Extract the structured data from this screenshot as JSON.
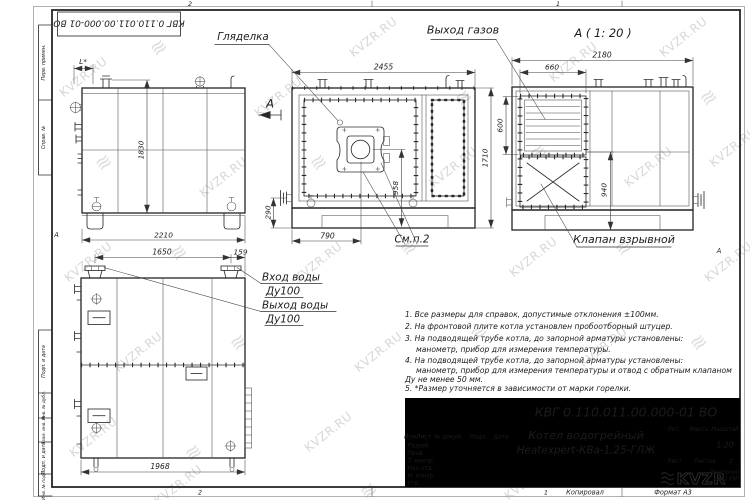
{
  "watermark": {
    "text": "KVZR.RU",
    "logo_glyph": "≋"
  },
  "sheet": {
    "doc_number_rotated": "КВГ 0.110.011.00.000-01 ВО",
    "zone_top_left": "2",
    "zone_top_right": "1",
    "zone_bottom_left": "2",
    "zone_bottom_right": "1",
    "fold_mark_left": "А",
    "fold_mark_right": "А",
    "margin_boxes": {
      "perv": "Перв. примен.",
      "sprav": "Справ. №",
      "podp1": "Подп. и дата",
      "inv_dubl": "Инв. № дубл.",
      "vzam": "Взам. инв. №",
      "podp2": "Подп. и дата",
      "inv_podl": "Инв. № подл."
    },
    "copied": "Копировал",
    "format": "Формат А3"
  },
  "views": {
    "side": {
      "dim_l": "L*",
      "dim_height": "1830",
      "dim_width": "2210",
      "view_arrow": "А"
    },
    "front": {
      "sight_glass": "Гляделка",
      "see_item": "См.п.2",
      "dim_width": "2455",
      "dim_height": "1710",
      "dim_axis": "958",
      "dim_burner": "790",
      "dim_pipe": "290"
    },
    "rear": {
      "title": "А ( 1: 20 )",
      "gas_outlet": "Выход газов",
      "explosion_valve": "Клапан взрывной",
      "dim_width": "2180",
      "dim_louver_w": "660",
      "dim_louver_h": "600",
      "dim_940": "940"
    },
    "plan": {
      "water_in": "Вход воды",
      "water_in_dn": "Ду100",
      "water_out": "Выход воды",
      "water_out_dn": "Ду100",
      "dim_1650": "1650",
      "dim_159": "159",
      "dim_1968": "1968"
    }
  },
  "notes": [
    "1. Все размеры для справок, допустимые отклонения ±100мм.",
    "2. На фронтовой плите котла установлен пробоотборный штуцер.",
    "3. На подводящей трубе котла, до запорной арматуры установлены:",
    "манометр, прибор для измерения температуры.",
    "4. На подводящей трубе котла, до запорной арматуры установлены:",
    "манометр, прибор для измерения температуры и отвод с обратным клапаном",
    "Ду не менее 50 мм.",
    "5. *Размер уточняется в зависимости от марки горелки."
  ],
  "title_block": {
    "doc_number": "КВГ 0.110.011.00.000-01 ВО",
    "product_line1": "Котел водогрейный",
    "product_line2": "Heatexpert-КВа-1,25-ГЛЖ",
    "col_izm": "Изм.",
    "col_list": "Лист",
    "col_doc": "№ докум.",
    "col_podp": "Подп.",
    "col_data": "Дата",
    "row_razrab": "Разраб.",
    "row_prov": "Пров.",
    "row_tkontr": "Т. контр.",
    "row_nach": "Нач.отд.",
    "row_nkontr": "Н. контр.",
    "row_utv": "Утв.",
    "lit_label": "Лит.",
    "mass_label": "Масса",
    "scale_label": "Масштаб",
    "scale_value": "1:20",
    "sheet_label": "Лист",
    "sheets_label": "Листов",
    "sheets_value": "1",
    "logo_text": "KVZR",
    "logo_sub_line1": "Котельный",
    "logo_sub_line2": "завод РЭП"
  }
}
